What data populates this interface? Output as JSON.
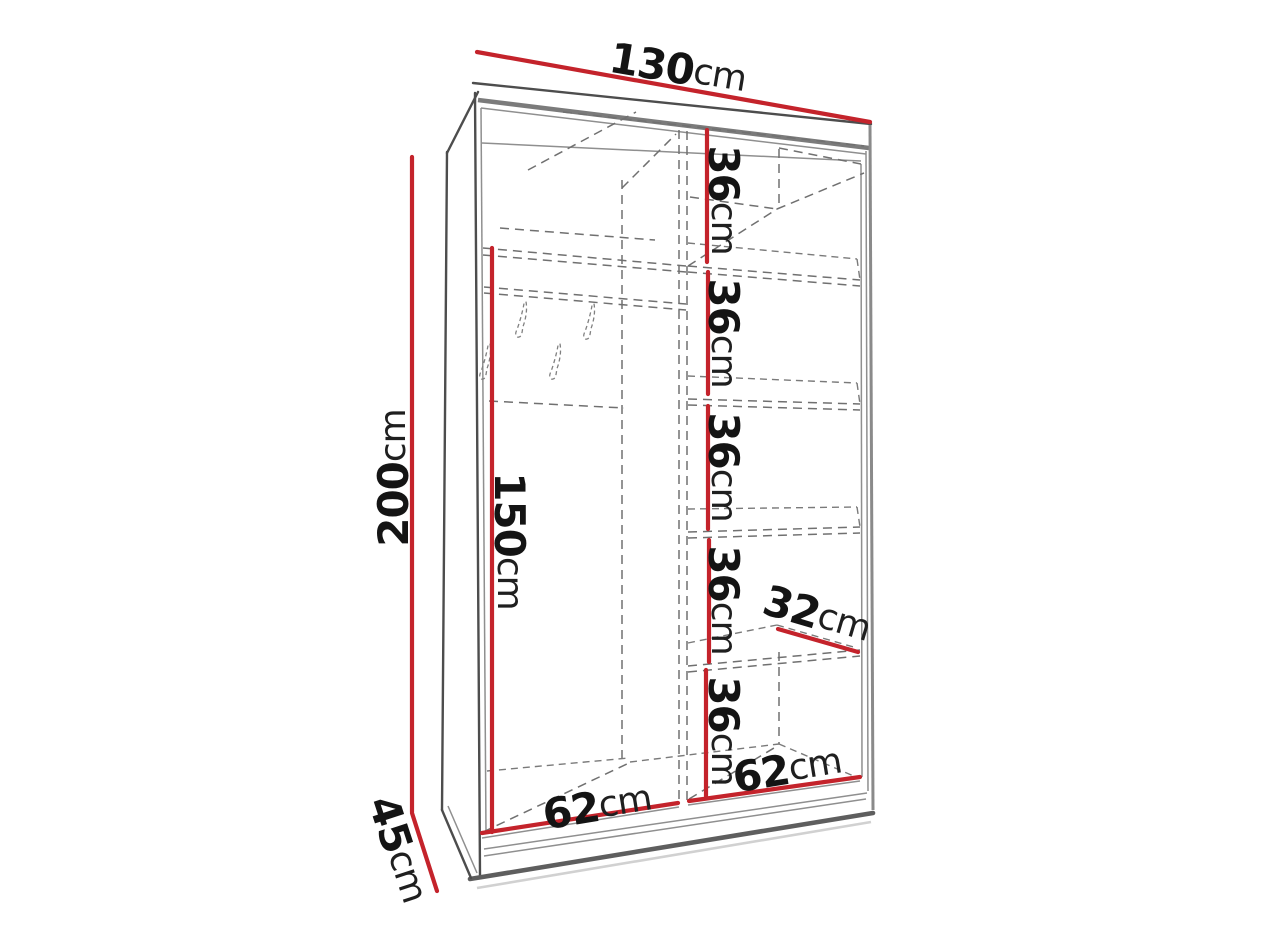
{
  "figure": {
    "kind": "wardrobe-dimension-diagram",
    "description": "Perspective line drawing of a two-section sliding-door wardrobe interior with red dimension lines",
    "sections": {
      "left": "hanging compartment with hook rail and four hooks",
      "right": "shelf column with five equal spacings"
    }
  },
  "dimensions": {
    "width": {
      "value": "130",
      "unit": "cm"
    },
    "height": {
      "value": "200",
      "unit": "cm"
    },
    "depth": {
      "value": "45",
      "unit": "cm"
    },
    "hanging_height": {
      "value": "150",
      "unit": "cm"
    },
    "shelf_depth": {
      "value": "32",
      "unit": "cm"
    },
    "left_section_width": {
      "value": "62",
      "unit": "cm"
    },
    "right_section_width": {
      "value": "62",
      "unit": "cm"
    },
    "shelf_spacings": [
      {
        "value": "36",
        "unit": "cm"
      },
      {
        "value": "36",
        "unit": "cm"
      },
      {
        "value": "36",
        "unit": "cm"
      },
      {
        "value": "36",
        "unit": "cm"
      },
      {
        "value": "36",
        "unit": "cm"
      }
    ]
  },
  "colors": {
    "dimension_red": "#c4232b",
    "outline_gray": "#7b7b7b",
    "dashed_gray": "#707070",
    "text": "#141414",
    "background": "#ffffff"
  }
}
